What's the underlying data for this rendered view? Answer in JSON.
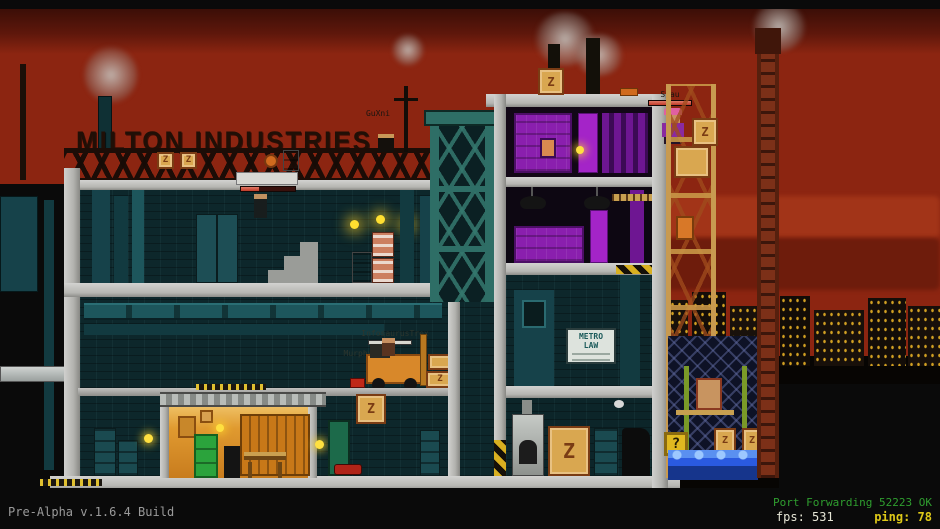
{
  "hud": {
    "build": "Pre-Alpha v.1.6.4 Build",
    "network_status": "Port Forwarding 52223 OK",
    "fps_label": "fps:",
    "fps": "531",
    "ping_label": "ping:",
    "ping": "78"
  },
  "world": {
    "factory_sign": "MILTON INDUSTRIES",
    "metro_line1": "METRO",
    "metro_line2": "LAW",
    "mystery_box": "?",
    "crate_letter": "Z"
  },
  "players": {
    "p1": {
      "name": "GuXni"
    },
    "p2": {
      "name": "Spau"
    },
    "p3": {
      "name": "InfosaurusTrex"
    },
    "p4": {
      "name": "Murphy"
    }
  },
  "colors": {
    "sky": "#8c2511",
    "building_teal": "#0d272b",
    "accent_purple": "#a424c8",
    "garage_orange": "#e09a30",
    "water_blue": "#2a5ae0",
    "hud_green": "#2f9e2f",
    "hud_yellow": "#ddc818"
  }
}
